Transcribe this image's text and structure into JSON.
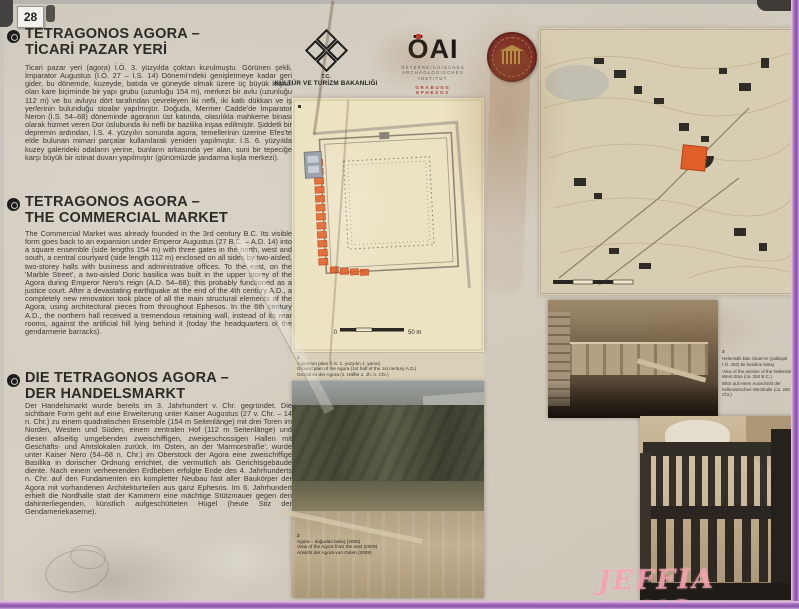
{
  "badge": "28",
  "sections": {
    "tr": {
      "title1": "TETRAGONOS AGORA –",
      "title2": "TİCARİ PAZAR YERİ",
      "body": "Ticari pazar yeri (agora) İ.Ö. 3. yüzyılda çoktan kurulmuştu. Görünen şekli, İmparator Augustus (İ.Ö. 27 – İ.S. 14) Dönemi'ndeki genişletmeye kadar geri gider, bu dönemde, kuzeyde, batıda ve güneyde olmak üzere üç büyük kapısı olan kare biçiminde bir yapı grubu (uzunluğu 154 m), merkezi bir avlu (uzunluğu 112 m) ve bu avluyu dört tarafından çevreleyen iki nefli, iki katlı dükkan ve iş yerlerinin bulunduğu stoalar yapılmıştır. Doğuda, Mermer Cadde'de İmparator Neron (İ.S. 54–68) döneminde agoranın üst katında, olasılıkla mahkeme binası olarak hizmet veren Dor üslubunda iki nefli bir bazilika inşaa edilmiştir. Şiddetli bir depremin ardından, İ.S. 4. yüzyılın sonunda agora, temellerinin üzerine Efes'te elde bulunan mimari parçalar kullanılarak yeniden yapılmıştır. İ.S. 6. yüzyılda kuzey galerideki odaların yerine, bunların arkasında yer alan, suni bir tepeciğe karşı büyük bir istinat duvarı yapılmıştır (günümüzde jandarma kışla merkezi)."
    },
    "en": {
      "title1": "TETRAGONOS AGORA –",
      "title2": "THE COMMERCIAL MARKET",
      "body": "The Commercial Market was already founded in the 3rd century B.C. Its visible form goes back to an expansion under Emperor Augustus (27 B.C. – A.D. 14) into a square ensemble (side lengths 154 m) with three gates in the north, west and south, a central courtyard (side length 112 m) enclosed on all sides by two-aisled, two-storey halls with business and administrative offices. To the east, on the 'Marble Street', a two-aisled Doric basilica was built in the upper storey of the Agora during Emperor Nero's reign (A.D. 54–68); this probably functioned as a justice court. After a devastating earthquake at the end of the 4th century A.D., a completely new renovation took place of all the main structural elements of the Agora, using architectural pieces from throughout Ephesos. In the 6th century A.D., the northern hall received a tremendous retaining wall, instead of its rear rooms, against the artificial hill lying behind it (today the headquarters of the gendarmerie barracks)."
    },
    "de": {
      "title1": "DIE TETRAGONOS AGORA –",
      "title2": "DER HANDELSMARKT",
      "body": "Der Handelsmarkt wurde bereits im 3. Jahrhundert v. Chr. gegründet. Die sichtbare Form geht auf eine Erweiterung unter Kaiser Augustus (27 v. Chr. – 14 n. Chr.) zu einem quadratischen Ensemble (154 m Seitenlänge) mit drei Toren im Norden, Westen und Süden, einem zentralen Hof (112 m Seitenlänge) und diesen allseitig umgebenden zweischiffigen, zweigeschossigen Hallen mit Geschäfts- und Amtslokalen zurück. Im Osten, an der 'Marmorstraße', wurde unter Kaiser Nero (54–68 n. Chr.) im Oberstock der Agora eine zweischiffige Basilika in dorischer Ordnung errichtet, die vermutlich als Gerichtsgebäude diente. Nach einem verheerenden Erdbeben erfolgte Ende des 4. Jahrhunderts n. Chr. auf den Fundamenten ein kompletter Neubau fast aller Baukörper der Agora mit vorhandenen Architekturteilen aus ganz Ephesos. Im 6. Jahrhundert erhielt die Nordhalle statt der Kammern eine mächtige Stützmauer gegen den dahinterliegenden, künstlich aufgeschütteten Hügel (heute Sitz der Gendameriekaserne)."
    }
  },
  "logos": {
    "ministry": {
      "org": "T.C.",
      "name": "KÜLTÜR VE TURİZM BAKANLIĞI"
    },
    "oai": {
      "acronym": "ÖAI",
      "sub1": "ÖSTERREICHISCHES",
      "sub2": "ARCHÄOLOGISCHES",
      "sub3": "INSTITUT",
      "dig": "GRABUNG EPHESOS"
    }
  },
  "figures": {
    "plan": {
      "num": "1",
      "tr": "Agora'nın planı (İ.S. 1. yüzyılın 1. yarısı)",
      "en": "Ground plan of the Agora (1st half of the 1st century A.D.)",
      "de": "Grundriss der Agora (1. Hälfte 1. Jh. n. Chr.)",
      "scale_zero": "0",
      "scale_end": "50 m"
    },
    "aerial": {
      "num": "2",
      "tr": "Agora – doğudan bakış (2009)",
      "en": "View of the Agora from the east (2009)",
      "de": "Ansicht der Agora von Osten (2009)"
    },
    "stoa": {
      "num": "3",
      "tr": "Helenistik Batı Stoa'nın (yaklaşık İ.Ö. 250) bir kesitine bakış",
      "en": "View of the section of the hellenistic West Stoa (ca. 250 B.C.)",
      "de": "Blick auf einen Ausschnitt der hellenistischen Westhalle (ca. 250 v. Chr.)"
    }
  },
  "watermark": "JEFFIA FANG",
  "colors": {
    "accent_orange": "#e2622a",
    "frame_purple": "#8a55a8",
    "watermark_pink": "#f2a0ac",
    "medallion_red": "#7a2a22",
    "plan_cream": "#ece3c3",
    "map_beige": "#d7cdb2"
  }
}
